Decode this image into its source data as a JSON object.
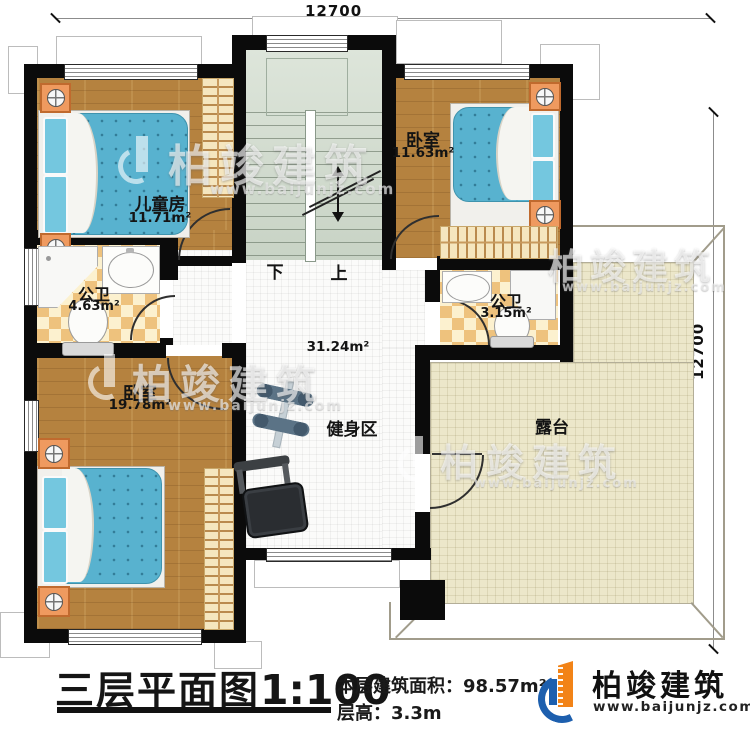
{
  "dimensions": {
    "top": "12700",
    "right": "12700"
  },
  "stairs": {
    "down": "下",
    "up": "上"
  },
  "rooms": {
    "kids": {
      "name": "儿童房",
      "area": "11.71m²"
    },
    "bedroom_top": {
      "name": "卧室",
      "area": "11.63m²"
    },
    "bath_left": {
      "name": "公卫",
      "area": "4.63m²"
    },
    "bath_right": {
      "name": "公卫",
      "area": "3.15m²"
    },
    "bedroom_bottom": {
      "name": "卧室",
      "area": "19.78m²"
    },
    "gym": {
      "name": "健身区",
      "area": "31.24m²"
    },
    "terrace": {
      "name": "露台"
    }
  },
  "title": {
    "main": "三层平面图",
    "scale": "1:100",
    "area_label": "本层建筑面积：",
    "area_value": "98.57m²",
    "height_label": "层高：",
    "height_value": "3.3m"
  },
  "brand": {
    "name": "柏竣建筑",
    "url": "www.baijunjz.com"
  },
  "watermark": {
    "name": "柏竣建筑",
    "url": "www.baijunjz.com"
  },
  "colors": {
    "wall": "#0b0b0b",
    "wood": "#b5823f",
    "tile_a": "#eec27d",
    "tile_b": "#fcf1cf",
    "stair": "#cfdacc",
    "terrace": "#ece7ca",
    "bed": "#58b2cf",
    "brand_orange": "#f28317",
    "brand_blue": "#1d5fae"
  }
}
